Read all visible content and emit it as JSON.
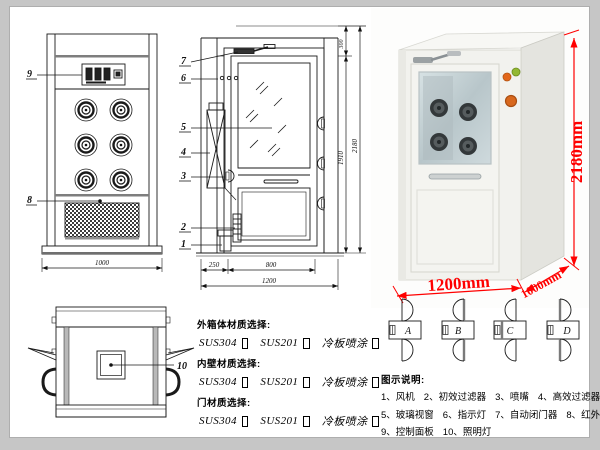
{
  "drawing": {
    "front_view": {
      "label_9": "9",
      "label_8": "8",
      "dim_width": "1000"
    },
    "side_view": {
      "label_7": "7",
      "label_6": "6",
      "label_5": "5",
      "label_4": "4",
      "label_3": "3",
      "label_2": "2",
      "label_1": "1",
      "dim_top": "300",
      "dim_door": "1910",
      "dim_total": "2180",
      "dim_left": "250",
      "dim_mid": "800",
      "dim_width": "1200"
    },
    "top_view": {
      "label_10": "10"
    }
  },
  "photo": {
    "dim_height": "2180mm",
    "dim_width": "1200mm",
    "dim_depth": "1000mm",
    "dim_color": "#ff0000"
  },
  "materials": {
    "groups": [
      {
        "title": "外箱体材质选择:",
        "opt1": "SUS304",
        "opt2": "SUS201",
        "opt3": "冷板喷涂"
      },
      {
        "title": "内壁材质选择:",
        "opt1": "SUS304",
        "opt2": "SUS201",
        "opt3": "冷板喷涂"
      },
      {
        "title": "门材质选择:",
        "opt1": "SUS304",
        "opt2": "SUS201",
        "opt3": "冷板喷涂"
      }
    ]
  },
  "door_options": {
    "a": "A",
    "b": "B",
    "c": "C",
    "d": "D"
  },
  "legend": {
    "title": "图示说明:",
    "row1": [
      "1、风机",
      "2、初效过滤器",
      "3、喷嘴",
      "4、高效过滤器"
    ],
    "row2": [
      "5、玻璃视窗",
      "6、指示灯",
      "7、自动闭门器",
      "8、红外线感应器"
    ],
    "row3": [
      "9、控制面板",
      "10、照明灯"
    ]
  }
}
